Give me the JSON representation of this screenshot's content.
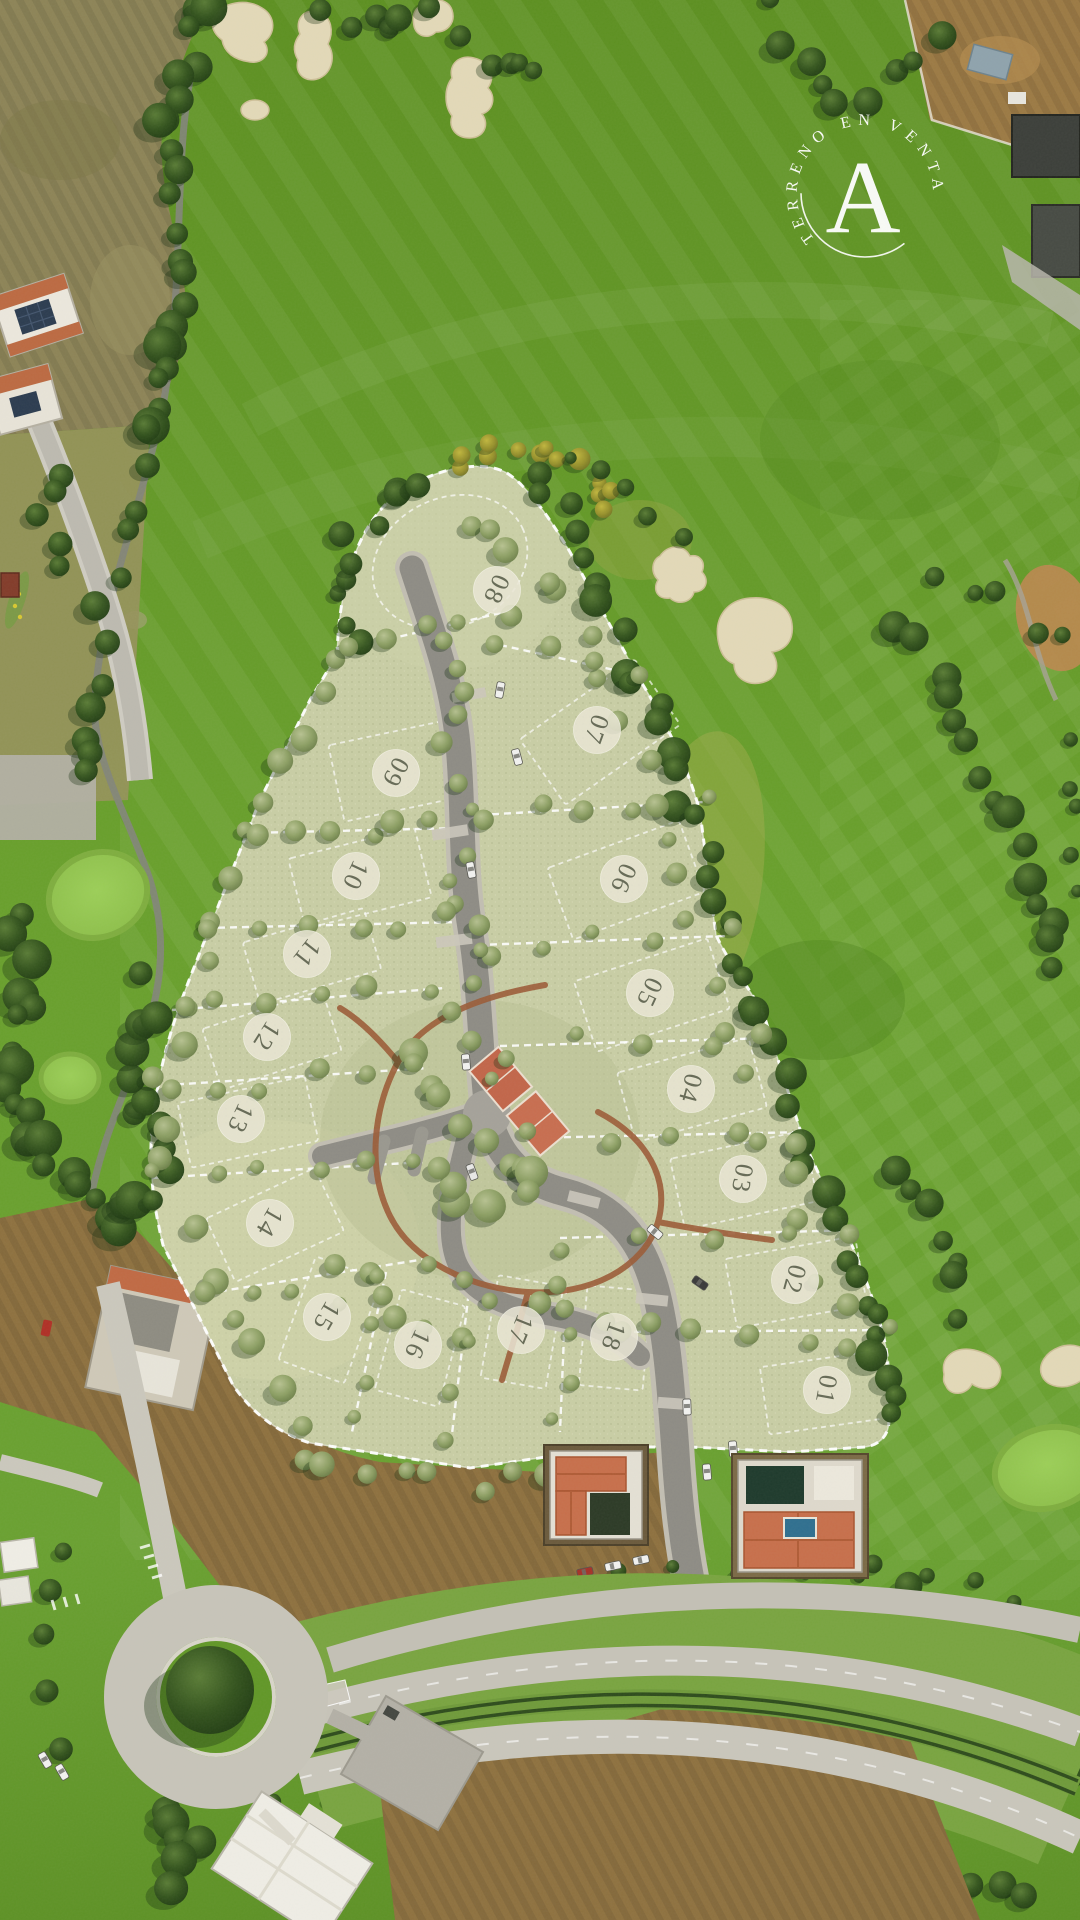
{
  "badge": {
    "arc_text": "TERRENO EN VENTA",
    "monogram": "A",
    "color": "#ffffff"
  },
  "site_plan": {
    "lot_badge_fill": "#eae7d6",
    "lot_badge_text_color": "#5b604c",
    "boundary_color": "#ffffff",
    "lots": [
      {
        "number": "01",
        "x": 827,
        "y": 1390,
        "rot": 100
      },
      {
        "number": "02",
        "x": 795,
        "y": 1280,
        "rot": 105
      },
      {
        "number": "03",
        "x": 743,
        "y": 1179,
        "rot": 100
      },
      {
        "number": "04",
        "x": 691,
        "y": 1089,
        "rot": 105
      },
      {
        "number": "05",
        "x": 650,
        "y": 993,
        "rot": 115
      },
      {
        "number": "06",
        "x": 624,
        "y": 879,
        "rot": 115
      },
      {
        "number": "07",
        "x": 597,
        "y": 730,
        "rot": 110
      },
      {
        "number": "08",
        "x": 497,
        "y": 590,
        "rot": 115
      },
      {
        "number": "09",
        "x": 396,
        "y": 773,
        "rot": 118
      },
      {
        "number": "10",
        "x": 356,
        "y": 876,
        "rot": 115
      },
      {
        "number": "11",
        "x": 307,
        "y": 954,
        "rot": 128
      },
      {
        "number": "12",
        "x": 267,
        "y": 1037,
        "rot": 122
      },
      {
        "number": "13",
        "x": 241,
        "y": 1119,
        "rot": 115
      },
      {
        "number": "14",
        "x": 270,
        "y": 1223,
        "rot": 120
      },
      {
        "number": "15",
        "x": 327,
        "y": 1317,
        "rot": 120
      },
      {
        "number": "16",
        "x": 418,
        "y": 1345,
        "rot": 115
      },
      {
        "number": "17",
        "x": 521,
        "y": 1330,
        "rot": 112
      },
      {
        "number": "18",
        "x": 614,
        "y": 1337,
        "rot": 110
      }
    ]
  },
  "palette": {
    "fairway_green": "#649b28",
    "site_sage": "#c9cea5",
    "tennis_clay": "#c2664a",
    "trail_red": "#9c5c38",
    "road_gray": "#8e8c85",
    "sand": "#e3d9b8",
    "logo_white": "#ffffff"
  }
}
